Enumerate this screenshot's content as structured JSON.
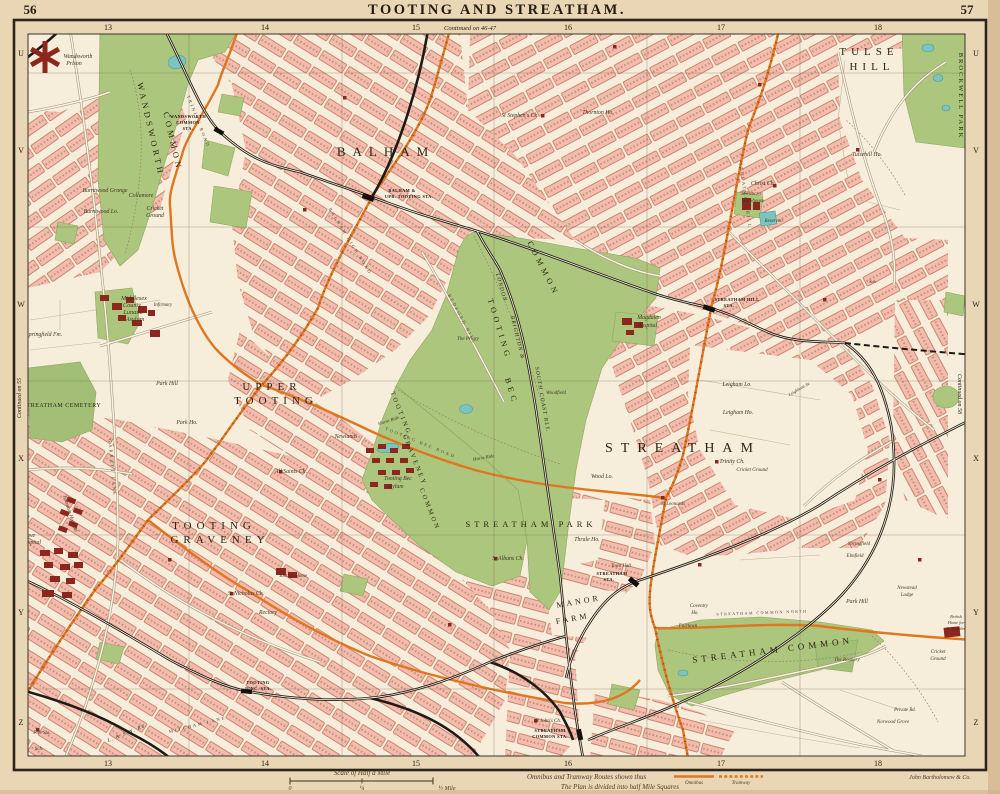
{
  "page": {
    "left_no": "56",
    "right_no": "57",
    "title": "TOOTING AND STREATHAM."
  },
  "grid": {
    "columns": [
      {
        "label": "13",
        "x": 108
      },
      {
        "label": "14",
        "x": 265
      },
      {
        "label": "15",
        "x": 416
      },
      {
        "label": "16",
        "x": 568
      },
      {
        "label": "17",
        "x": 721
      },
      {
        "label": "18",
        "x": 878
      }
    ],
    "rows": [
      {
        "label": "U",
        "y": 53
      },
      {
        "label": "V",
        "y": 150
      },
      {
        "label": "W",
        "y": 304
      },
      {
        "label": "X",
        "y": 458
      },
      {
        "label": "Y",
        "y": 612
      },
      {
        "label": "Z",
        "y": 722
      }
    ],
    "continued_top": "Continued on 46-47",
    "continued_left": "Continued on 55",
    "continued_right": "Continued on 58"
  },
  "footer": {
    "scale_title": "Scale of Half a Mile",
    "scale_zero": "0",
    "scale_quarter": "¼",
    "scale_half": "½ Mile",
    "legend_routes": "Omnibus and Tramway Routes shown thus",
    "legend_omnibus": "Omnibus",
    "legend_tramway": "Tramway",
    "legend_plan": "The Plan is divided into half Mile Squares",
    "publisher": "John Bartholomew & Co."
  },
  "colors": {
    "paper": "#e9d6b4",
    "map_background": "#f6eedb",
    "housing_block": "#f2bdae",
    "housing_outline": "#c06a52",
    "common_green": "#adc67e",
    "water": "#7ac5c1",
    "railway": "#1f1a14",
    "omnibus_route": "#e0761f",
    "important_building": "#8e2620",
    "frame": "#2a241c"
  },
  "map_labels": [
    {
      "t": "BALHAM",
      "x": 386,
      "y": 156,
      "s": 13,
      "ls": 7,
      "st": "district"
    },
    {
      "t": "UPPER",
      "x": 272,
      "y": 390,
      "s": 11,
      "ls": 5,
      "st": "district"
    },
    {
      "t": "TOOTING",
      "x": 276,
      "y": 404,
      "s": 11,
      "ls": 5,
      "st": "district"
    },
    {
      "t": "TOOTING",
      "x": 214,
      "y": 529,
      "s": 11,
      "ls": 5,
      "st": "district"
    },
    {
      "t": "GRAVENEY",
      "x": 220,
      "y": 543,
      "s": 11,
      "ls": 5,
      "st": "district"
    },
    {
      "t": "STREATHAM",
      "x": 683,
      "y": 452,
      "s": 14,
      "ls": 8,
      "st": "district"
    },
    {
      "t": "TULSE",
      "x": 869,
      "y": 55,
      "s": 11,
      "ls": 5,
      "st": "district"
    },
    {
      "t": "HILL",
      "x": 872,
      "y": 70,
      "s": 11,
      "ls": 5,
      "st": "district"
    },
    {
      "t": "STREATHAM COMMON",
      "x": 773,
      "y": 653,
      "s": 9,
      "ls": 4,
      "st": "district",
      "r": -7
    },
    {
      "t": "WANDSWORTH",
      "x": 148,
      "y": 130,
      "s": 8.5,
      "ls": 3.5,
      "st": "district",
      "r": 77
    },
    {
      "t": "COMMON",
      "x": 170,
      "y": 142,
      "s": 8.5,
      "ls": 3.5,
      "st": "district",
      "r": 77
    },
    {
      "t": "COMMON",
      "x": 541,
      "y": 270,
      "s": 8,
      "ls": 4,
      "st": "district",
      "r": 63
    },
    {
      "t": "TOOTING",
      "x": 497,
      "y": 330,
      "s": 8,
      "ls": 4,
      "st": "district",
      "r": 73
    },
    {
      "t": "BEC",
      "x": 509,
      "y": 392,
      "s": 8,
      "ls": 4,
      "st": "district",
      "r": 73
    },
    {
      "t": "TOOTING",
      "x": 399,
      "y": 414,
      "s": 6.5,
      "ls": 2.5,
      "st": "district",
      "r": 68
    },
    {
      "t": "GRAVENEY",
      "x": 413,
      "y": 461,
      "s": 6.5,
      "ls": 2.5,
      "st": "district",
      "r": 68
    },
    {
      "t": "COMMON",
      "x": 428,
      "y": 510,
      "s": 6.5,
      "ls": 2.5,
      "st": "district",
      "r": 68
    },
    {
      "t": "STREATHAM PARK",
      "x": 531,
      "y": 527,
      "s": 8.5,
      "ls": 4,
      "st": "district"
    },
    {
      "t": "MANOR",
      "x": 579,
      "y": 604,
      "s": 8,
      "ls": 3,
      "st": "district",
      "r": -10
    },
    {
      "t": "FARM",
      "x": 573,
      "y": 621,
      "s": 8,
      "ls": 3,
      "st": "district",
      "r": -10
    },
    {
      "t": "STREATHAM CEMETERY",
      "x": 62,
      "y": 407,
      "s": 6,
      "ls": 0.5,
      "st": "district"
    },
    {
      "t": "BROCKWELL PARK",
      "x": 959,
      "y": 96,
      "s": 6.5,
      "ls": 2,
      "st": "district",
      "r": 90
    },
    {
      "t": "WANDSWORTH",
      "x": 188,
      "y": 118,
      "s": 4.3,
      "st": "station"
    },
    {
      "t": "COMMON",
      "x": 188,
      "y": 124,
      "s": 4.3,
      "st": "station"
    },
    {
      "t": "STA.",
      "x": 188,
      "y": 130,
      "s": 4.3,
      "st": "station"
    },
    {
      "t": "BALHAM &",
      "x": 402,
      "y": 192,
      "s": 4.3,
      "st": "station"
    },
    {
      "t": "UPR. TOOTING STA.",
      "x": 409,
      "y": 198,
      "s": 4.3,
      "st": "station"
    },
    {
      "t": "STREATHAM HILL",
      "x": 737,
      "y": 301,
      "s": 4.3,
      "st": "station"
    },
    {
      "t": "STA.",
      "x": 729,
      "y": 307,
      "s": 4.3,
      "st": "station"
    },
    {
      "t": "STREATHAM",
      "x": 612,
      "y": 575,
      "s": 4.3,
      "st": "station"
    },
    {
      "t": "STA.",
      "x": 609,
      "y": 581,
      "s": 4.3,
      "st": "station"
    },
    {
      "t": "STREATHAM",
      "x": 550,
      "y": 732,
      "s": 4.3,
      "st": "station"
    },
    {
      "t": "COMMON STA.",
      "x": 550,
      "y": 738,
      "s": 4.3,
      "st": "station"
    },
    {
      "t": "TOOTING",
      "x": 258,
      "y": 684,
      "s": 4.3,
      "st": "station"
    },
    {
      "t": "JUNC. STA.",
      "x": 258,
      "y": 690,
      "s": 4.3,
      "st": "station"
    },
    {
      "t": "LONDON",
      "x": 500,
      "y": 288,
      "s": 5.5,
      "st": "rail",
      "r": 74
    },
    {
      "t": "BRIGHTON &",
      "x": 516,
      "y": 338,
      "s": 5.5,
      "st": "rail",
      "r": 76
    },
    {
      "t": "SOUTH COAST RLY.",
      "x": 541,
      "y": 400,
      "s": 5.5,
      "st": "rail",
      "r": 80
    },
    {
      "t": "L. & S.W. RY.",
      "x": 128,
      "y": 734,
      "s": 5,
      "st": "rail",
      "r": -22
    },
    {
      "t": "MITCHAM LANE",
      "x": 198,
      "y": 726,
      "s": 4.5,
      "ls": 2,
      "st": "road",
      "r": -14
    },
    {
      "t": "STREATHAM HILL",
      "x": 744,
      "y": 196,
      "s": 4.5,
      "ls": 2,
      "st": "road",
      "r": 82
    },
    {
      "t": "GARRATT LANE",
      "x": 111,
      "y": 468,
      "s": 4.5,
      "ls": 2,
      "st": "road",
      "r": 85
    },
    {
      "t": "BEDFORD HILL",
      "x": 461,
      "y": 320,
      "s": 4.5,
      "ls": 2,
      "st": "road",
      "r": 62
    },
    {
      "t": "TRINITY ROAD",
      "x": 197,
      "y": 122,
      "s": 4.5,
      "ls": 2,
      "st": "road",
      "r": 68
    },
    {
      "t": "BALHAM HIGH ROAD",
      "x": 349,
      "y": 242,
      "s": 4.5,
      "ls": 2,
      "st": "road",
      "r": 58
    },
    {
      "t": "TOOTING BEC ROAD",
      "x": 420,
      "y": 444,
      "s": 4.5,
      "ls": 2,
      "st": "road",
      "r": 22
    },
    {
      "t": "STREATHAM COMMON NORTH",
      "x": 762,
      "y": 614,
      "s": 4,
      "ls": 1.5,
      "st": "road",
      "r": -2
    },
    {
      "t": "Wandsworth",
      "x": 78,
      "y": 58
    },
    {
      "t": "Prison",
      "x": 74,
      "y": 65
    },
    {
      "t": "Burntwood Grange",
      "x": 105,
      "y": 192
    },
    {
      "t": "Burntwood Lo.",
      "x": 101,
      "y": 213
    },
    {
      "t": "Collamore",
      "x": 141,
      "y": 197
    },
    {
      "t": "Cricket",
      "x": 155,
      "y": 210
    },
    {
      "t": "Ground",
      "x": 155,
      "y": 217
    },
    {
      "t": "Middlesex",
      "x": 134,
      "y": 300,
      "s": 6.3
    },
    {
      "t": "County",
      "x": 132,
      "y": 307,
      "s": 6.3
    },
    {
      "t": "Lunatic",
      "x": 133,
      "y": 314,
      "s": 6.3
    },
    {
      "t": "Asylum",
      "x": 135,
      "y": 321,
      "s": 6.3
    },
    {
      "t": "Infirmary",
      "x": 163,
      "y": 306,
      "s": 4.8
    },
    {
      "t": "Springfield Fm.",
      "x": 44,
      "y": 336
    },
    {
      "t": "Park Hill",
      "x": 167,
      "y": 385
    },
    {
      "t": "Park Ho.",
      "x": 187,
      "y": 424
    },
    {
      "t": "Grove",
      "x": 28,
      "y": 537
    },
    {
      "t": "Hospital",
      "x": 31,
      "y": 544
    },
    {
      "t": "Fountain Hospital",
      "x": 69,
      "y": 514,
      "r": 72,
      "s": 5.2
    },
    {
      "t": "St Nicholas Ch.",
      "x": 246,
      "y": 595
    },
    {
      "t": "Rectory",
      "x": 268,
      "y": 614
    },
    {
      "t": "Tooting Home",
      "x": 293,
      "y": 577,
      "s": 5
    },
    {
      "t": "All Saints Ch.",
      "x": 291,
      "y": 473
    },
    {
      "t": "Newlands",
      "x": 346,
      "y": 438
    },
    {
      "t": "Tooting Bec",
      "x": 398,
      "y": 480
    },
    {
      "t": "Asylum",
      "x": 395,
      "y": 488
    },
    {
      "t": "The Priory",
      "x": 468,
      "y": 340,
      "s": 5
    },
    {
      "t": "Woodfield",
      "x": 556,
      "y": 394,
      "s": 5
    },
    {
      "t": "Magdalen",
      "x": 649,
      "y": 319
    },
    {
      "t": "Hospital",
      "x": 647,
      "y": 327
    },
    {
      "t": "St Stephen's Ch.",
      "x": 520,
      "y": 117
    },
    {
      "t": "Thornton Ho.",
      "x": 598,
      "y": 114
    },
    {
      "t": "Tulsehill Ho.",
      "x": 867,
      "y": 156
    },
    {
      "t": "Christ Ch.",
      "x": 763,
      "y": 185
    },
    {
      "t": "St Pancras",
      "x": 752,
      "y": 195,
      "s": 5
    },
    {
      "t": "Workhouse",
      "x": 753,
      "y": 202,
      "s": 5
    },
    {
      "t": "Reservoir",
      "x": 774,
      "y": 222,
      "s": 4.8
    },
    {
      "t": "Leigham Lo.",
      "x": 737,
      "y": 386
    },
    {
      "t": "Leigham Ho.",
      "x": 738,
      "y": 414
    },
    {
      "t": "Trinity Ch.",
      "x": 732,
      "y": 463
    },
    {
      "t": "Cricket Ground",
      "x": 752,
      "y": 471,
      "s": 5
    },
    {
      "t": "St Leonards",
      "x": 673,
      "y": 505,
      "s": 5
    },
    {
      "t": "Wood Lo.",
      "x": 602,
      "y": 478
    },
    {
      "t": "Thrale Ho.",
      "x": 587,
      "y": 541
    },
    {
      "t": "St Albans Ch.",
      "x": 508,
      "y": 560
    },
    {
      "t": "Town Hall",
      "x": 621,
      "y": 567,
      "s": 4.8
    },
    {
      "t": "Coventry",
      "x": 699,
      "y": 607,
      "s": 5
    },
    {
      "t": "Ho.",
      "x": 695,
      "y": 614,
      "s": 5
    },
    {
      "t": "Fairlawn",
      "x": 688,
      "y": 627,
      "s": 5
    },
    {
      "t": "Park Hill",
      "x": 857,
      "y": 603
    },
    {
      "t": "Newstead",
      "x": 907,
      "y": 589,
      "s": 5
    },
    {
      "t": "Lodge",
      "x": 907,
      "y": 596,
      "s": 5
    },
    {
      "t": "Springfield",
      "x": 859,
      "y": 545,
      "s": 5
    },
    {
      "t": "Elmfield",
      "x": 855,
      "y": 557,
      "s": 5
    },
    {
      "t": "The Rookery",
      "x": 847,
      "y": 661,
      "s": 5
    },
    {
      "t": "Cricket",
      "x": 938,
      "y": 653,
      "s": 5
    },
    {
      "t": "Ground",
      "x": 938,
      "y": 660,
      "s": 5
    },
    {
      "t": "Norwood Grove",
      "x": 893,
      "y": 723,
      "s": 5
    },
    {
      "t": "Private Rd.",
      "x": 905,
      "y": 711,
      "s": 4.8
    },
    {
      "t": "British",
      "x": 956,
      "y": 618,
      "s": 4.3
    },
    {
      "t": "Home for",
      "x": 956,
      "y": 624,
      "s": 4.3
    },
    {
      "t": "Incurables",
      "x": 956,
      "y": 630,
      "s": 4.3
    },
    {
      "t": "St John's Ch.",
      "x": 548,
      "y": 722,
      "s": 5
    },
    {
      "t": "Fire Sta.",
      "x": 42,
      "y": 734,
      "s": 5
    },
    {
      "t": "Sch.",
      "x": 39,
      "y": 750,
      "s": 5
    },
    {
      "t": "Horse Ride",
      "x": 389,
      "y": 422,
      "r": -18,
      "s": 4.8
    },
    {
      "t": "Horse Ride",
      "x": 484,
      "y": 459,
      "r": -10,
      "s": 4.8
    },
    {
      "t": "Sch.",
      "x": 873,
      "y": 283,
      "s": 4.5
    },
    {
      "t": "Leighham Av.",
      "x": 800,
      "y": 390,
      "s": 4.5,
      "r": -30
    }
  ]
}
